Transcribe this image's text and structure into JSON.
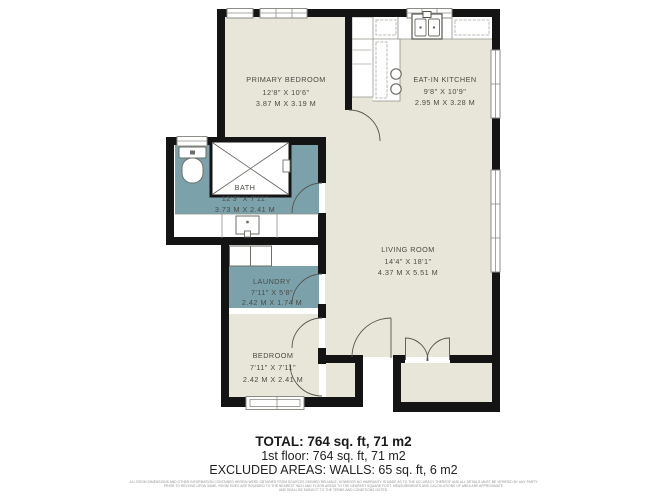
{
  "plan": {
    "colors": {
      "wall": "#141414",
      "floor": "#e8e6d8",
      "wet_room": "#7ba2ab"
    },
    "rooms": [
      {
        "name": "PRIMARY BEDROOM",
        "imperial": "12'8\" X 10'6\"",
        "metric": "3.87 M X 3.19 M"
      },
      {
        "name": "EAT-IN KITCHEN",
        "imperial": "9'8\" X 10'9\"",
        "metric": "2.95 M X 3.28 M"
      },
      {
        "name": "BATH",
        "imperial": "12'3\" X 7'11\"",
        "metric": "3.73 M X 2.41 M"
      },
      {
        "name": "LIVING ROOM",
        "imperial": "14'4\" X 18'1\"",
        "metric": "4.37 M X 5.51 M"
      },
      {
        "name": "LAUNDRY",
        "imperial": "7'11\" X 5'8\"",
        "metric": "2.42 M X 1.74 M"
      },
      {
        "name": "BEDROOM",
        "imperial": "7'11\" X 7'11\"",
        "metric": "2.42 M X 2.41 M"
      }
    ]
  },
  "summary": {
    "total": "TOTAL: 764 sq. ft, 71 m2",
    "first_floor": "1st floor: 764 sq. ft, 71 m2",
    "excluded_areas": "EXCLUDED AREAS: WALLS: 65 sq. ft, 6 m2"
  },
  "disclaimer": {
    "line1": "ALL ROOM DIMENSIONS AND OTHER INFORMATION CONTAINED HEREIN WERE OBTAINED FROM SOURCES DEEMED RELIABLE; HOWEVER NO WARRANTY IS MADE AS TO THE ACCURACY THEREOF AND ALL DETAILS MUST BE VERIFIED BY ANY PARTY",
    "line2": "PRIOR TO RELYING UPON SAME. ROOM SIZES ARE ROUNDED TO THE NEAREST INCH AND FLOOR AREAS TO THE NEAREST SQUARE FOOT. MEASUREMENTS AND CALCULATIONS OF AREA ARE APPROXIMATE",
    "line3": "AND SHALL BE SUBJECT TO THE TERMS AND CONDITIONS NOTED."
  }
}
